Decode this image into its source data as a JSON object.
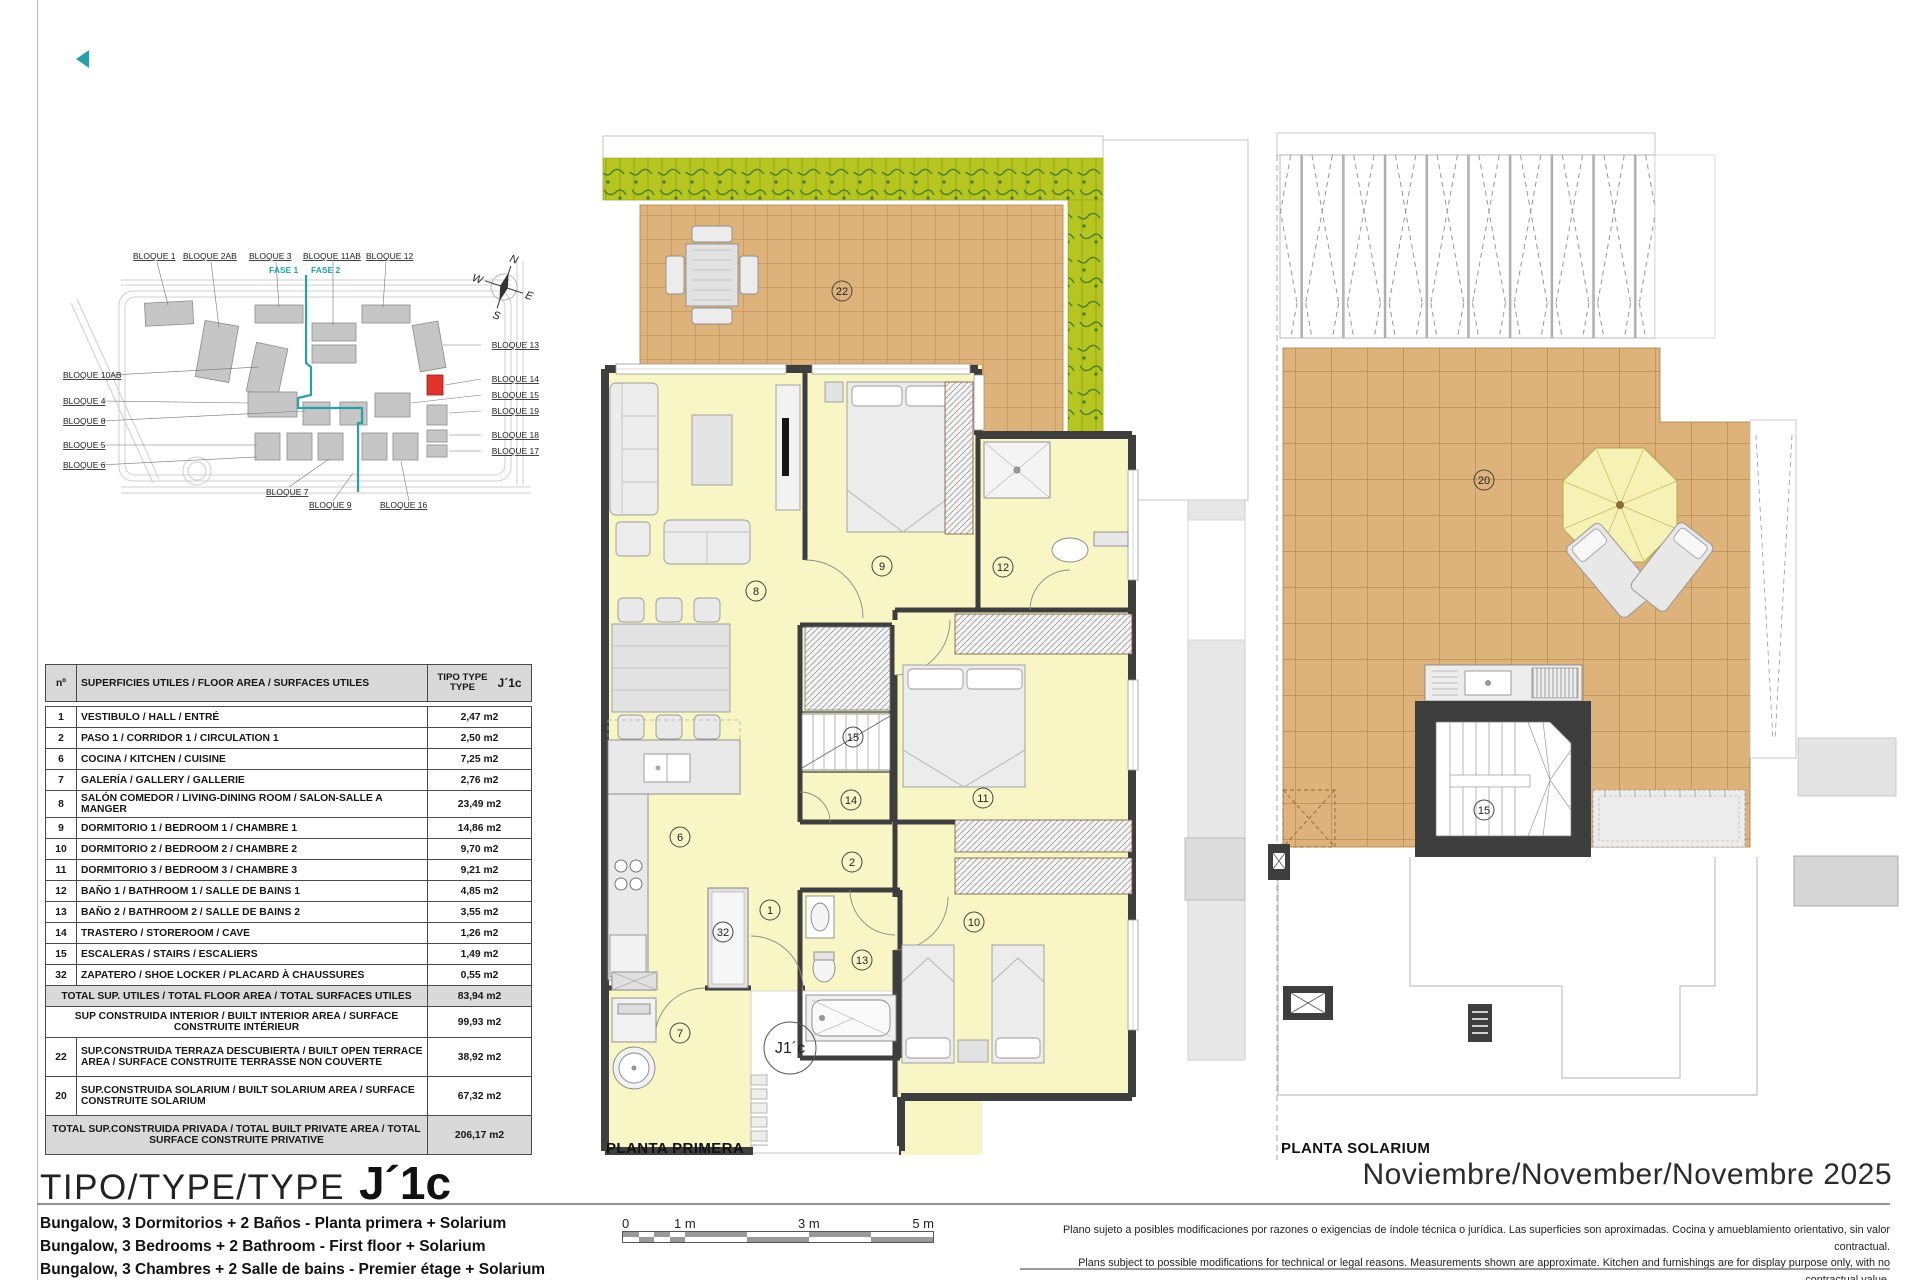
{
  "logo": {
    "color": "#2a9fa8"
  },
  "title_block": {
    "type_label": "TIPO/TYPE/TYPE",
    "type_code": "J´1c",
    "date": "Noviembre/November/Novembre 2025",
    "descriptions": [
      "Bungalow, 3 Dormitorios + 2 Baños - Planta primera + Solarium",
      "Bungalow, 3 Bedrooms + 2 Bathroom - First floor + Solarium",
      "Bungalow, 3 Chambres + 2 Salle de bains - Premier étage + Solarium"
    ]
  },
  "site_plan": {
    "top_labels": [
      "BLOQUE 1",
      "BLOQUE 2AB",
      "BLOQUE 3",
      "BLOQUE 11AB",
      "BLOQUE 12"
    ],
    "left_labels": [
      "BLOQUE 10AB",
      "BLOQUE 4",
      "BLOQUE 8",
      "BLOQUE 5",
      "BLOQUE 6"
    ],
    "right_labels": [
      "BLOQUE 13",
      "BLOQUE 14",
      "BLOQUE 15",
      "BLOQUE 19",
      "BLOQUE 18",
      "BLOQUE 17"
    ],
    "bottom_labels": [
      "BLOQUE 7",
      "BLOQUE 9",
      "BLOQUE 16"
    ],
    "phase_labels": [
      "FASE 1",
      "FASE 2"
    ],
    "compass": {
      "n": "N",
      "e": "E",
      "s": "S",
      "w": "W"
    },
    "highlight_color": "#e0342b",
    "phase_color": "#2a9fa8"
  },
  "area_table": {
    "header": {
      "num": "nº",
      "desc": "SUPERFICIES UTILES / FLOOR AREA / SURFACES UTILES",
      "tipo_line1": "TIPO TYPE",
      "tipo_line2": "TYPE",
      "code": "J´1c"
    },
    "rows": [
      {
        "num": "1",
        "desc": "VESTIBULO / HALL / ENTRÉ",
        "val": "2,47 m2"
      },
      {
        "num": "2",
        "desc": "PASO 1 / CORRIDOR 1 / CIRCULATION 1",
        "val": "2,50 m2"
      },
      {
        "num": "6",
        "desc": "COCINA / KITCHEN / CUISINE",
        "val": "7,25 m2"
      },
      {
        "num": "7",
        "desc": "GALERÍA / GALLERY / GALLERIE",
        "val": "2,76 m2"
      },
      {
        "num": "8",
        "desc": "SALÓN COMEDOR  / LIVING-DINING ROOM / SALON-SALLE A MANGER",
        "val": "23,49 m2"
      },
      {
        "num": "9",
        "desc": "DORMITORIO 1 / BEDROOM 1 / CHAMBRE 1",
        "val": "14,86 m2"
      },
      {
        "num": "10",
        "desc": "DORMITORIO 2 / BEDROOM 2 / CHAMBRE 2",
        "val": "9,70 m2"
      },
      {
        "num": "11",
        "desc": "DORMITORIO 3 / BEDROOM 3 / CHAMBRE 3",
        "val": "9,21 m2"
      },
      {
        "num": "12",
        "desc": "BAÑO 1 / BATHROOM 1 / SALLE DE BAINS 1",
        "val": "4,85 m2"
      },
      {
        "num": "13",
        "desc": "BAÑO 2 / BATHROOM 2 / SALLE DE BAINS 2",
        "val": "3,55 m2"
      },
      {
        "num": "14",
        "desc": "TRASTERO / STOREROOM / CAVE",
        "val": "1,26 m2"
      },
      {
        "num": "15",
        "desc": "ESCALERAS / STAIRS / ESCALIERS",
        "val": "1,49 m2"
      },
      {
        "num": "32",
        "desc": "ZAPATERO / SHOE LOCKER / PLACARD À CHAUSSURES",
        "val": "0,55 m2"
      },
      {
        "num": "",
        "desc": "TOTAL SUP. UTILES / TOTAL FLOOR AREA / TOTAL SURFACES UTILES",
        "val": "83,94 m2"
      },
      {
        "num": "",
        "desc": "SUP CONSTRUIDA INTERIOR / BUILT INTERIOR AREA /  SURFACE CONSTRUITE INTÉRIEUR",
        "val": "99,93 m2"
      },
      {
        "num": "22",
        "desc": "SUP.CONSTRUIDA TERRAZA DESCUBIERTA  / BUILT OPEN TERRACE AREA / SURFACE CONSTRUITE TERRASSE NON COUVERTE",
        "val": "38,92 m2"
      },
      {
        "num": "20",
        "desc": "SUP.CONSTRUIDA SOLARIUM / BUILT SOLARIUM  AREA / SURFACE CONSTRUITE SOLARIUM",
        "val": "67,32 m2"
      },
      {
        "num": "",
        "desc": "TOTAL SUP.CONSTRUIDA PRIVADA / TOTAL  BUILT PRIVATE AREA / TOTAL SURFACE CONSTRUITE PRIVATIVE",
        "val": "206,17 m2"
      }
    ]
  },
  "plans": {
    "primera": {
      "caption": "PLANTA PRIMERA",
      "unit_label": "J1´c",
      "rooms": {
        "terrace": "22",
        "living": "8",
        "bedroom1": "9",
        "bath1": "12",
        "stairs": "15",
        "storeroom": "14",
        "corridor": "2",
        "bedroom3": "11",
        "kitchen": "6",
        "hall": "1",
        "shoe": "32",
        "bath2": "13",
        "bedroom2": "10",
        "gallery": "7"
      }
    },
    "solarium": {
      "caption": "PLANTA SOLARIUM",
      "rooms": {
        "solarium": "20",
        "stairs": "15"
      }
    }
  },
  "scale_bar": {
    "labels": [
      "0",
      "1 m",
      "3 m",
      "5 m"
    ]
  },
  "disclaimer": {
    "es": "Plano sujeto a posibles modificaciones por razones o exigencias de índole técnica o jurídica. Las superficies son aproximadas. Cocina y amueblamiento orientativo, sin valor contractual.",
    "en": "Plans subject to possible modifications for technical or legal reasons. Measurements shown are approximate. Kitchen and furnishings are for display purpose only, with no contractual value.",
    "fr": "Plan soumis à modifications en fonction des besoins ou exigences d´ordre technique ou juridique. Les surfaces sont approximative. Cousine et ameublement indicatifs, sans valeur contratuelle."
  }
}
